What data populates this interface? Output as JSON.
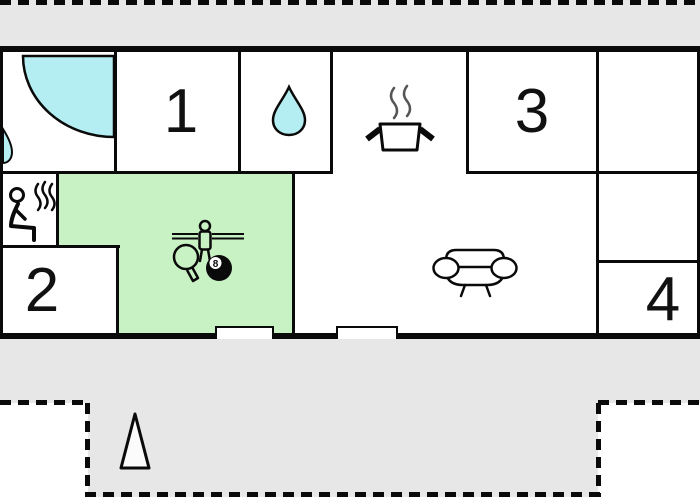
{
  "floorplan": {
    "type": "house-floor-plan",
    "room_labels": {
      "room1": "1",
      "room2": "2",
      "room3": "3",
      "room4": "4"
    },
    "icons": [
      "shower-icon",
      "washbasin-drop-icon",
      "water-drop-icon",
      "cooking-pot-icon",
      "sauna-person-icon",
      "foosball-player-icon",
      "table-tennis-paddle-icon",
      "billiard-eight-ball-icon",
      "sofa-icon",
      "tree-icon",
      "window-icon"
    ],
    "eight_ball": {
      "number": "8"
    },
    "areas": {
      "highlighted_room_color": "#c9f2c4",
      "water_icon_color": "#b4eef2",
      "terrace_color": "#e7e7e7",
      "wall_color": "#0a0a0a",
      "terrace_border_style": "dashed"
    },
    "window_count": "2"
  }
}
